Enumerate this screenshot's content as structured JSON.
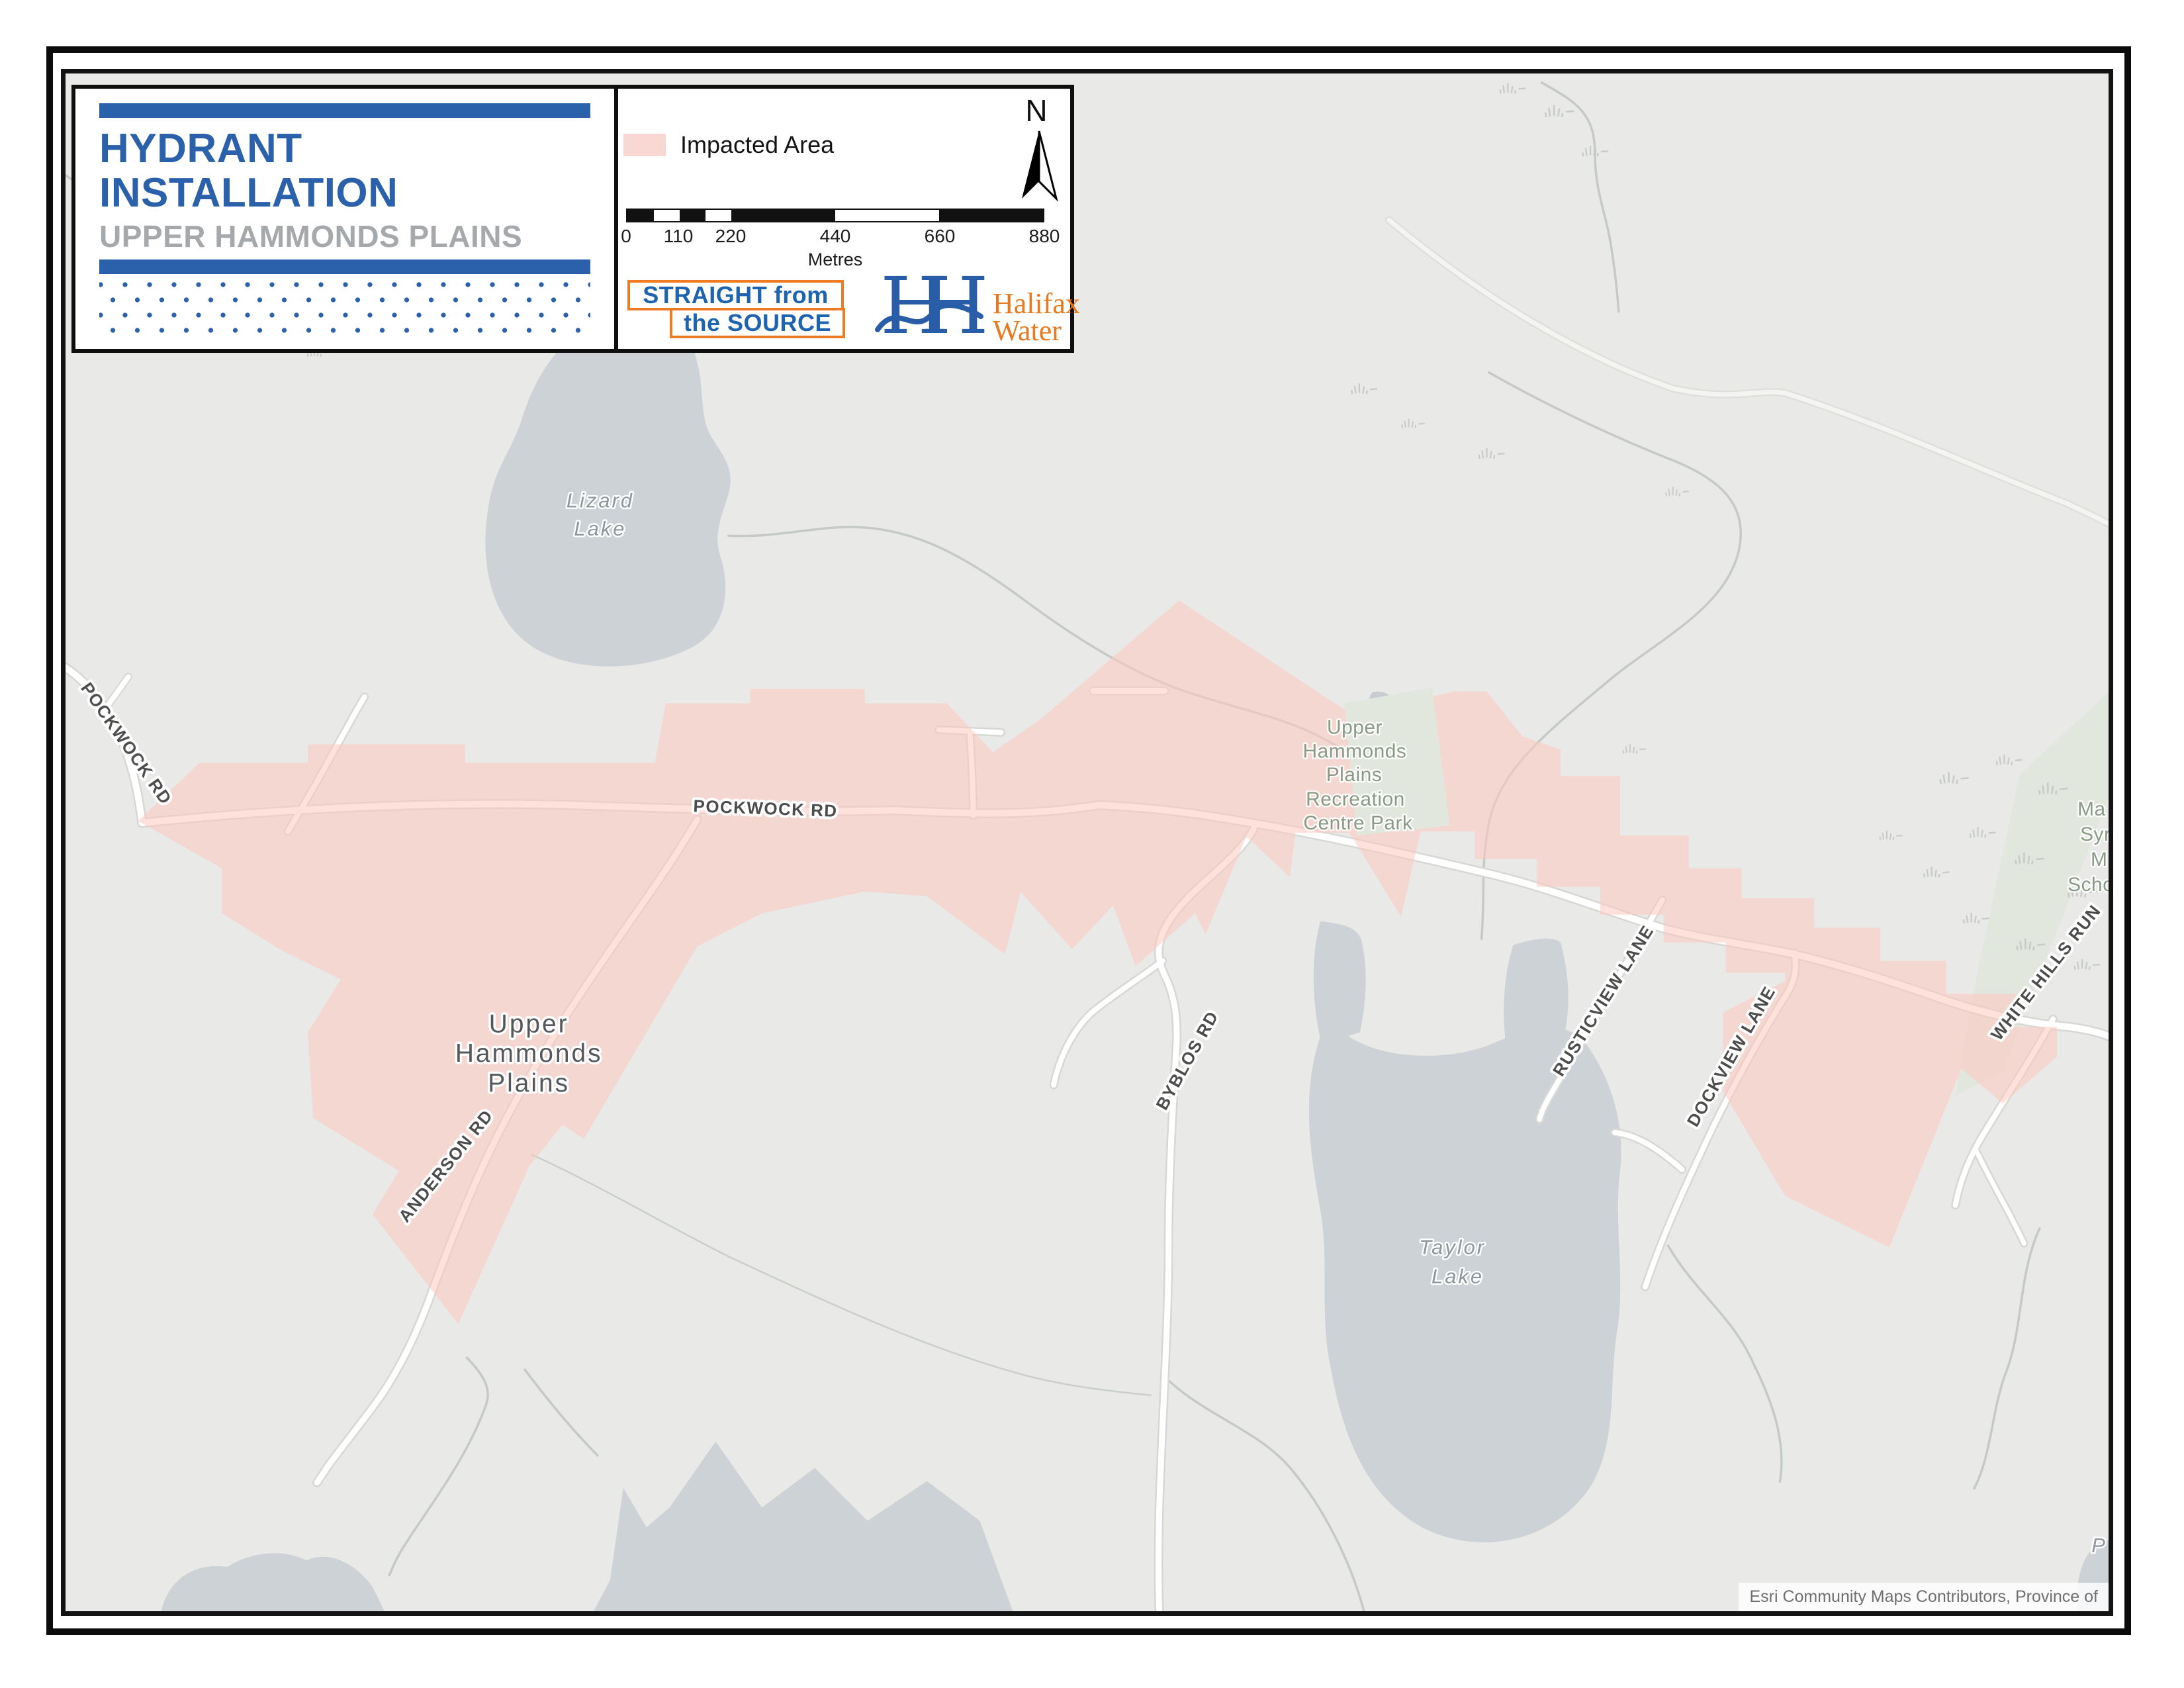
{
  "header": {
    "title_line1": "HYDRANT",
    "title_line2": "INSTALLATION",
    "subtitle": "UPPER HAMMONDS PLAINS",
    "legend_label": "Impacted Area",
    "north_label": "N",
    "scale": {
      "ticks": [
        "0",
        "110",
        "220",
        "440",
        "660",
        "880"
      ],
      "unit": "Metres"
    },
    "brand": {
      "straight_line1": "STRAIGHT from",
      "straight_line2": "the SOURCE",
      "monogram_h1": "H",
      "monogram_h2": "H",
      "halifax_line1": "Halifax",
      "halifax_line2": "Water"
    }
  },
  "map": {
    "roads": {
      "pockwock_west": "POCKWOCK RD",
      "pockwock": "POCKWOCK RD",
      "anderson": "ANDERSON RD",
      "byblos": "BYBLOS RD",
      "rusticview": "RUSTICVIEW LANE",
      "dockview": "DOCKVIEW LANE",
      "white_hills": "WHITE HILLS RUN"
    },
    "places": {
      "uhp": [
        "Upper",
        "Hammonds",
        "Plains"
      ]
    },
    "water": {
      "lizard": [
        "Lizard",
        "Lake"
      ],
      "taylor": [
        "Taylor",
        "Lake"
      ],
      "partial_label": "P"
    },
    "parks": {
      "recreation": [
        "Upper",
        "Hammonds",
        "Plains",
        "Recreation",
        "Centre Park"
      ],
      "school_partial": [
        "Ma",
        "Syr",
        "M",
        "Scho"
      ]
    },
    "attribution": "Esri Community Maps Contributors, Province of"
  },
  "colors": {
    "accent_blue": "#2B61AB",
    "subtitle_gray": "#A6A9AB",
    "impacted_pink": "#F9D7D2",
    "water_gray": "#CDD2D6",
    "park_green": "#E2E7DE",
    "brand_orange": "#EE7C25",
    "halifax_blue": "#2A5DA8",
    "halifax_orange": "#E8791F"
  }
}
